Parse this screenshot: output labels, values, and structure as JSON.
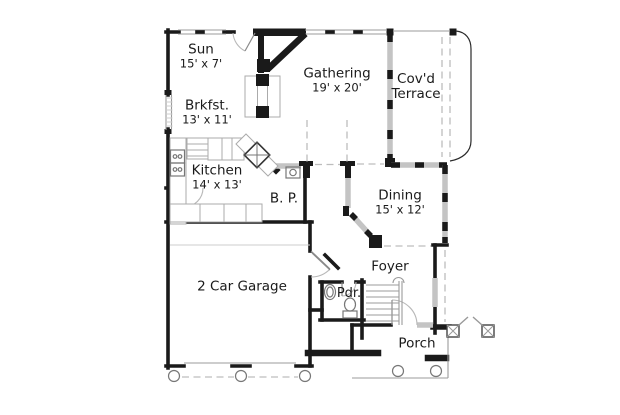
{
  "plan": {
    "type": "floor-plan",
    "rooms": {
      "sun": {
        "name": "Sun",
        "dims": "15' x 7'"
      },
      "gathering": {
        "name": "Gathering",
        "dims": "19' x 20'"
      },
      "terrace": {
        "name_top": "Cov'd",
        "name_bottom": "Terrace"
      },
      "brkfst": {
        "name": "Brkfst.",
        "dims": "13' x 11'"
      },
      "kitchen": {
        "name": "Kitchen",
        "dims": "14' x 13'"
      },
      "butlers_pantry": {
        "name": "B. P."
      },
      "dining": {
        "name": "Dining",
        "dims": "15' x 12'"
      },
      "garage": {
        "name": "2 Car Garage"
      },
      "foyer": {
        "name": "Foyer"
      },
      "powder": {
        "name": "Pdr."
      },
      "porch": {
        "name": "Porch"
      }
    },
    "colors": {
      "background": "#ffffff",
      "wall": "#1a1a1a",
      "window_band": "#c4c4c4",
      "thin_line": "#9b9b9b",
      "dashed": "#bdbdbd",
      "fixture": "#777777",
      "text": "#1a1a1a"
    }
  }
}
